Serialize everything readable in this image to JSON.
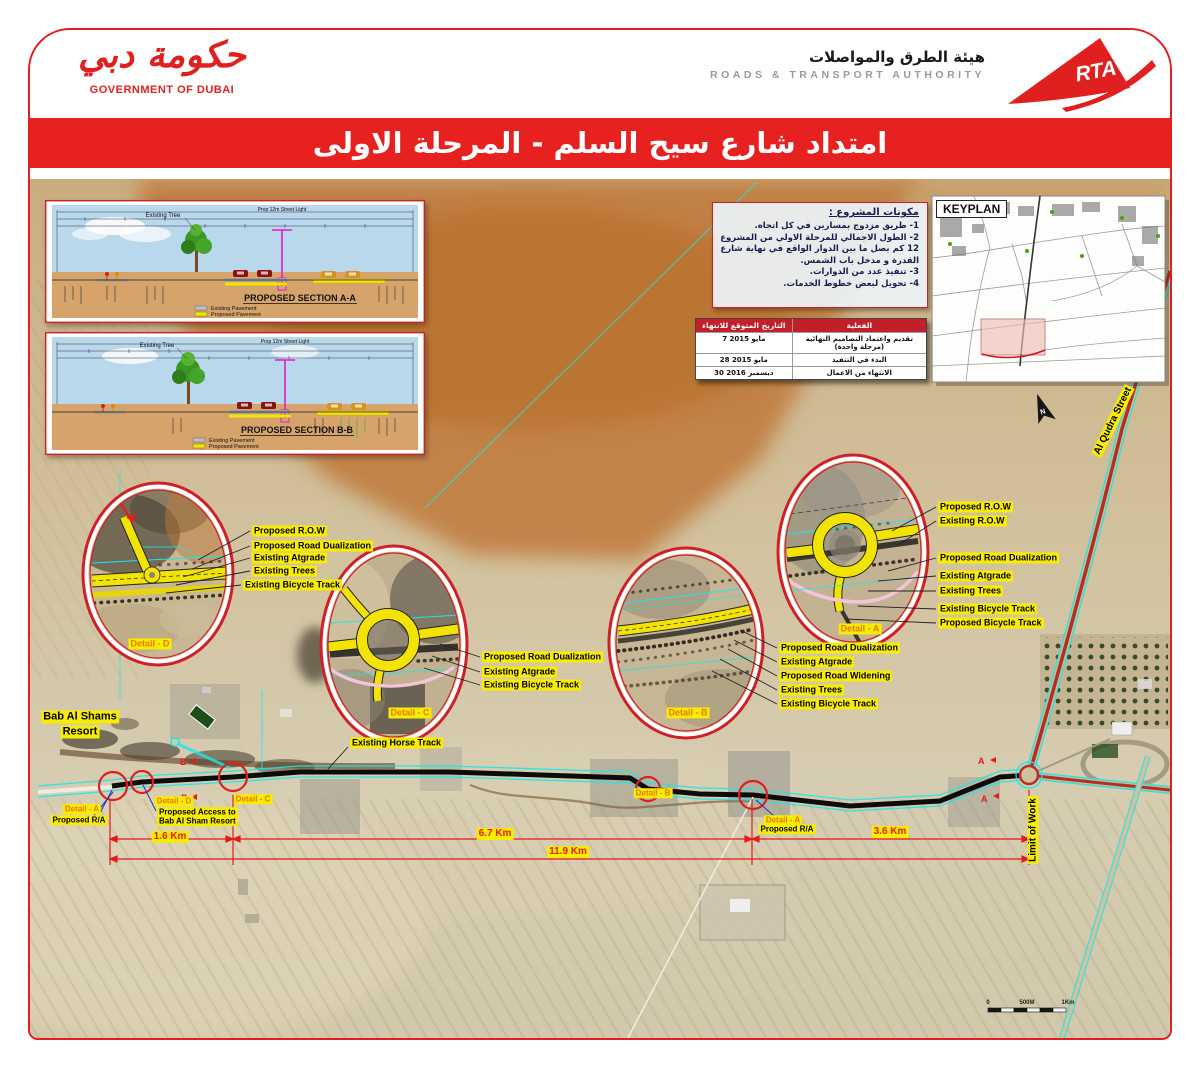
{
  "header": {
    "gov_logo_arabic": "حكومة دبي",
    "gov_logo_caption": "GOVERNMENT OF DUBAI",
    "rta_arabic": "هيئة الطرق والمواصلات",
    "rta_english": "ROADS & TRANSPORT AUTHORITY",
    "rta_logo": "RTA"
  },
  "title": "امتداد شارع سيح السلم - المرحلة الاولى",
  "sections": {
    "a_title": "PROPOSED SECTION A-A",
    "b_title": "PROPOSED SECTION B-B",
    "existing_tree": "Existing Tree",
    "street_light": "Prop 12m Street Light",
    "legend_existing": "Existing Pavement",
    "legend_proposed": "Proposed Pavement"
  },
  "project_box": {
    "title": "مكونات المشروع :",
    "items": [
      "1- طريق مزدوج بمسارين في كل اتجاه.",
      "2- الطول الاجمالي للمرحلة الاولي من المشروع 12 كم يصل ما بين الدوار الواقع في نهاية شارع القدرة و مدخل باب الشمس.",
      "3- تنفيذ عدد من الدوارات.",
      "4- تحويل لبعض خطوط الخدمات."
    ]
  },
  "schedule": {
    "header_date": "التاريخ المتوقع للانتهاء",
    "header_activity": "الفعلية",
    "rows": [
      {
        "date": "7 مايو 2015",
        "activity": "تقديم واعتماد التصاميم النهائية (مرحلة واحدة)"
      },
      {
        "date": "28 مايو 2015",
        "activity": "البدء في التنفيذ"
      },
      {
        "date": "30 ديسمبر 2016",
        "activity": "الانتهاء من الاعمال"
      }
    ]
  },
  "keyplan": {
    "title": "KEYPLAN"
  },
  "details": {
    "d": {
      "tag": "Detail - D",
      "labels": [
        "Proposed R.O.W",
        "Proposed Road Dualization",
        "Existing Atgrade",
        "Existing Trees",
        "Existing Bicycle Track"
      ]
    },
    "c": {
      "tag": "Detail - C",
      "labels": [
        "Proposed Road Dualization",
        "Existing Atgrade",
        "Existing Bicycle Track"
      ]
    },
    "b": {
      "tag": "Detail - B",
      "labels": [
        "Proposed Road Dualization",
        "Existing Atgrade",
        "Proposed Road Widening",
        "Existing Trees",
        "Existing Bicycle Track"
      ]
    },
    "a": {
      "tag": "Detail - A",
      "labels": [
        "Proposed R.O.W",
        "Existing R.O.W",
        "Proposed Road Dualization",
        "Existing Atgrade",
        "Existing Trees",
        "Existing Bicycle Track",
        "Proposed Bicycle Track"
      ]
    }
  },
  "map": {
    "resort_line1": "Bab Al Shams",
    "resort_line2": "Resort",
    "horse_track": "Existing Horse Track",
    "west_tag": "Detail - A",
    "west_sub": "Proposed R/A",
    "access_tag": "Detail - D",
    "access_line1": "Proposed Access to",
    "access_line2": "Bab Al Sham Resort",
    "tag_c": "Detail - C",
    "tag_b": "Detail - B",
    "east_tag": "Detail - A",
    "east_sub": "Proposed R/A",
    "dist_1": "1.6 Km",
    "dist_2": "6.7 Km",
    "dist_3": "11.9 Km",
    "dist_4": "3.6 Km",
    "limit_of_work": "Limit of Work",
    "al_qudra": "Al Qudra Street",
    "north": "N",
    "scale_0": "0",
    "scale_mid": "500M",
    "scale_end": "1Km",
    "marker_b": "B",
    "marker_a": "A"
  },
  "colors": {
    "brand_red": "#e01f1f",
    "highlight_yellow": "#f8ec00",
    "tag_orange": "#e8770a",
    "cyan_line": "#19e8e8",
    "proposed_yellow": "#f2e300"
  }
}
